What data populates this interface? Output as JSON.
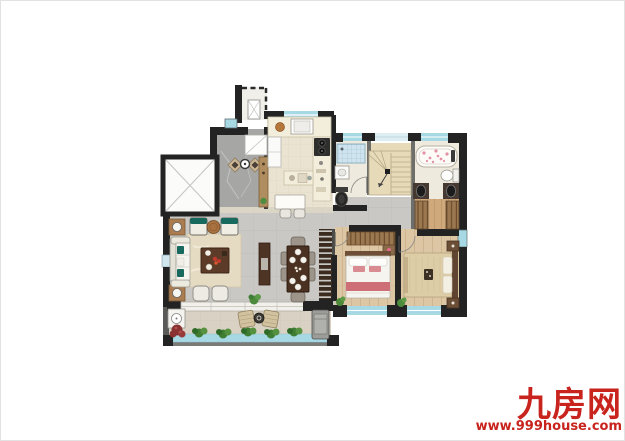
{
  "watermark": {
    "brand": "九房网",
    "url": "www.999house.com",
    "color": "#c8231d"
  },
  "floor_plan": {
    "type": "residential-floor-plan-top-view",
    "rooms": [
      "ac-platform",
      "entry-foyer",
      "elevator",
      "kitchen",
      "shared-bathroom",
      "staircase",
      "master-bathroom",
      "walk-in-closet",
      "living-room",
      "dining-area",
      "bedroom",
      "master-bedroom",
      "balcony",
      "hallway"
    ],
    "colors": {
      "wall": "#232323",
      "window_glass": "#a7d9e4",
      "living_tile": "#c9c8c4",
      "foyer_marble": "#a6a6a4",
      "wood_floor": "#dcc6a4",
      "kitchen_tile": "#eae3d1",
      "stair_tread": "#e6dab9",
      "balcony_floor": "#d9d2c4",
      "sofa_accent_teal": "#16695c",
      "bedding_pink": "#ce6f77",
      "plant_green": "#4d8a3c",
      "closet_wood": "#9b7850"
    }
  }
}
